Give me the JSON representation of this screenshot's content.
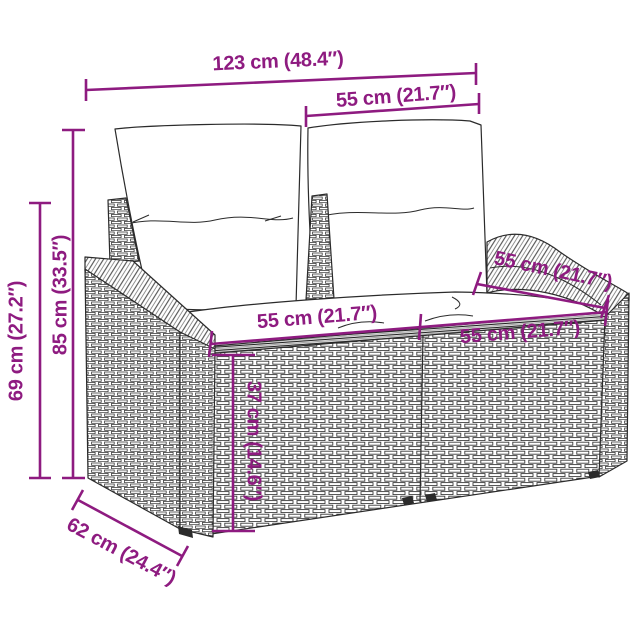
{
  "colors": {
    "accent": "#8e1b80",
    "outline": "#2b2b2b"
  },
  "dimensions": {
    "total_width": {
      "label": "123 cm (48.4″)"
    },
    "back_section_width": {
      "label": "55 cm (21.7″)"
    },
    "back_height": {
      "label": "85 cm (33.5″)"
    },
    "armrest_height": {
      "label": "69 cm (27.2″)"
    },
    "seat_height": {
      "label": "37 cm (14.6″)"
    },
    "seat_width_left": {
      "label": "55 cm (21.7″)"
    },
    "seat_width_right": {
      "label": "55 cm (21.7″)"
    },
    "armrest_depth": {
      "label": "55 cm (21.7″)"
    },
    "seat_depth": {
      "label": "62 cm (24.4″)"
    }
  }
}
